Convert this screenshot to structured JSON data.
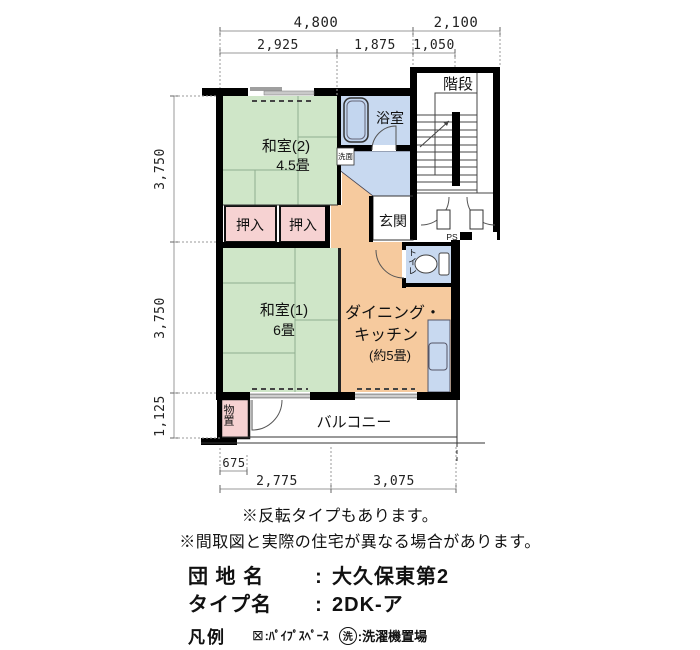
{
  "colors": {
    "tatami": "#cfe6c8",
    "closet": "#f6d2d2",
    "water": "#c8d9f0",
    "kitchen": "#f6ca9e",
    "tub": "#c3d6ef",
    "wall": "#000000"
  },
  "dims": {
    "top1": "4,800",
    "top2": "2,100",
    "mid1": "2,925",
    "mid2": "1,875",
    "mid3": "1,050",
    "left1": "3,750",
    "left2": "3,750",
    "left3": "1,125",
    "b675": "675",
    "b1": "2,775",
    "b2": "3,075"
  },
  "labels": {
    "kaidan": "階段",
    "yokushitsu": "浴室",
    "senmen": "洗面",
    "washitsu2": "和室(2)",
    "washitsu2_size": "4.5畳",
    "oshiire": "押入",
    "genkan": "玄関",
    "toire": "トイレ",
    "washitsu1": "和室(1)",
    "washitsu1_size": "6畳",
    "dk1": "ダイニング・",
    "dk2": "キッチン",
    "dk3": "(約5畳)",
    "monooki": "物置",
    "balcony": "バルコニー",
    "ps": "PS"
  },
  "notes": {
    "line1": "※反転タイプもあります。",
    "line2": "※間取図と実際の住宅が異なる場合があります。"
  },
  "info": {
    "danchi_label": "団 地 名",
    "colon": ":",
    "danchi_value": "大久保東第2",
    "type_label": "タイプ名",
    "type_value": "2DK-ア"
  },
  "legend": {
    "title": "凡例",
    "pipe_symbol": "⊠",
    "pipe_label": ":ﾊﾟｲﾌﾟｽﾍﾟｰｽ",
    "wash_symbol": "洗",
    "wash_label": ":洗濯機置場"
  }
}
